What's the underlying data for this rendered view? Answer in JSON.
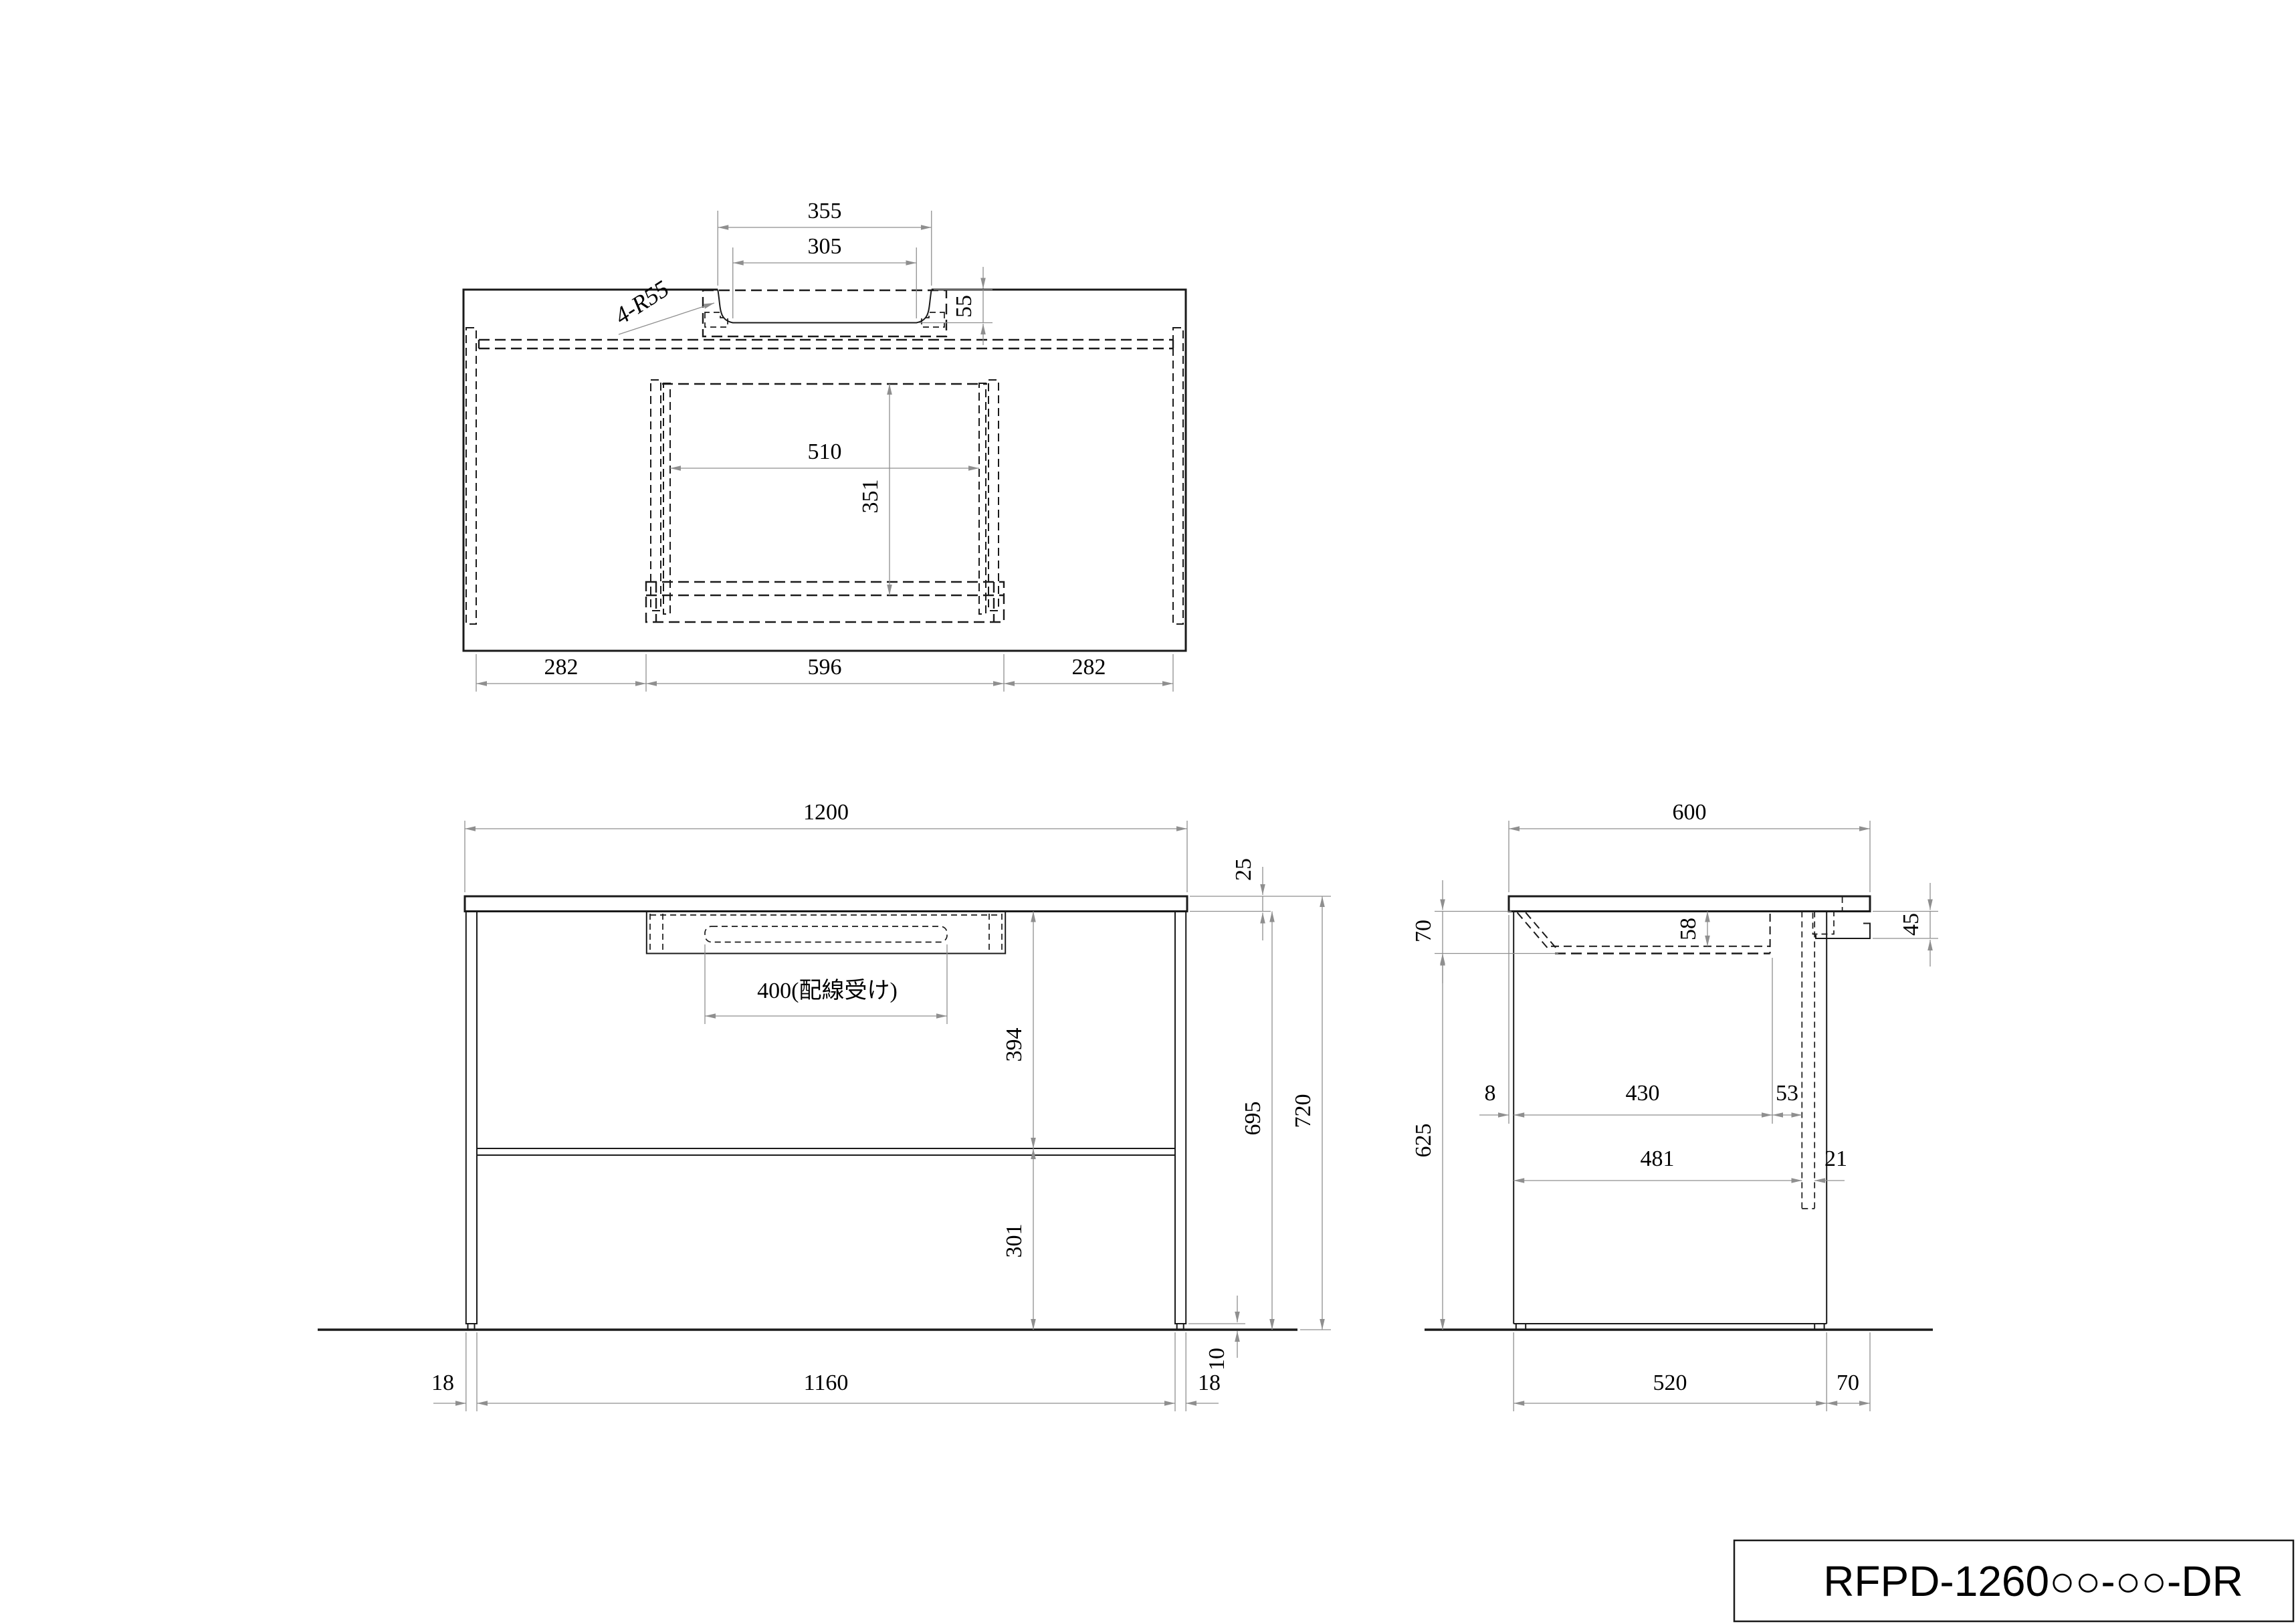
{
  "drawing": {
    "background": "#ffffff",
    "object_line_color": "#1a1a1a",
    "dimension_color": "#8f8f8f"
  },
  "views": {
    "top": {
      "d355": "355",
      "d305": "305",
      "r55": "4-R55",
      "d55": "55",
      "d510": "510",
      "d351": "351",
      "d282a": "282",
      "d596": "596",
      "d282b": "282"
    },
    "front": {
      "d1200": "1200",
      "d25": "25",
      "d400": "400(配線受け)",
      "d394": "394",
      "d695": "695",
      "d720": "720",
      "d301": "301",
      "d10": "10",
      "d18a": "18",
      "d1160": "1160",
      "d18b": "18"
    },
    "side": {
      "d600": "600",
      "d70a": "70",
      "d58": "58",
      "d45": "45",
      "d8": "8",
      "d430": "430",
      "d53": "53",
      "d481": "481",
      "d21": "21",
      "d625": "625",
      "d520": "520",
      "d70b": "70"
    }
  },
  "title_block": {
    "model_code": "RFPD-1260○○-○○-DR"
  }
}
